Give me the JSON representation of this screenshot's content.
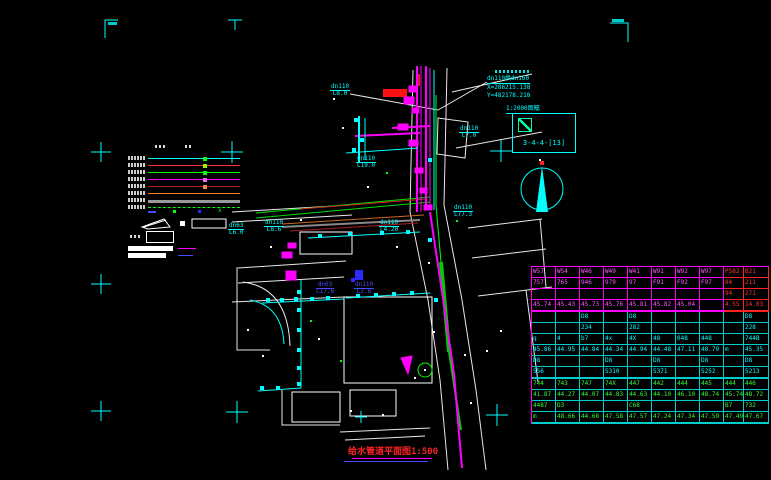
{
  "colors": {
    "background": "#000000",
    "frame": "#00ffff",
    "pipe_new": "#ff00ff",
    "pipe_existing": "#00ffff",
    "road_green": "#00dd00",
    "table_magenta": "#ff00ff",
    "table_red": "#ff3333",
    "table_cyan": "#00ffff",
    "table_green": "#33ff33",
    "title_red": "#ff2222"
  },
  "index_box": {
    "title": "1:2000图幅",
    "code": "3-4-4-[13]",
    "hatch_icon": "hatched-square"
  },
  "node_info": {
    "pipe": "dn110换dn160",
    "x": "X=286215.138",
    "y": "Y=482178.218"
  },
  "north_arrow": "north-arrow",
  "title_block": {
    "text": "给水管道平面图1:500"
  },
  "pipe_labels": [
    {
      "t": "dn110",
      "s": "L8.0",
      "x": 330,
      "y": 84,
      "c": "cyan"
    },
    {
      "t": "dn110",
      "s": "L7.0",
      "x": 459,
      "y": 126,
      "c": "cyan"
    },
    {
      "t": "dn63",
      "s": "L6.0",
      "x": 228,
      "y": 223,
      "c": "cyan"
    },
    {
      "t": "dn110",
      "s": "L8.6",
      "x": 264,
      "y": 220,
      "c": "cyan"
    },
    {
      "t": "dn110",
      "s": "L19.0",
      "x": 356,
      "y": 156,
      "c": "cyan"
    },
    {
      "t": "dn110",
      "s": "L4.20",
      "x": 379,
      "y": 220,
      "c": "cyan"
    },
    {
      "t": "dn110",
      "s": "L77.3",
      "x": 453,
      "y": 205,
      "c": "cyan"
    },
    {
      "t": "dn63",
      "s": "L17.6",
      "x": 316,
      "y": 282,
      "c": "blue"
    },
    {
      "t": "dn110",
      "s": "L2.6",
      "x": 354,
      "y": 282,
      "c": "blue"
    }
  ],
  "legend": {
    "rows": [
      {
        "color": "#00ffff",
        "style": "solid",
        "mark": "#00ff00"
      },
      {
        "color": "#ff2a2a",
        "style": "solid",
        "mark": "#88ff00"
      },
      {
        "color": "#00ff00",
        "style": "solid",
        "mark": "#00ff00"
      },
      {
        "color": "#ff00ff",
        "style": "solid",
        "mark": "#ff66ff"
      },
      {
        "color": "#b22222",
        "style": "solid",
        "mark": "#ff8844"
      },
      {
        "color": "#ff7f27",
        "style": "solid",
        "mark": ""
      },
      {
        "color": "#9a9a9a",
        "style": "thick",
        "mark": ""
      },
      {
        "color": "#00ff00",
        "style": "dashed",
        "mark": ""
      }
    ]
  },
  "table": {
    "col_widths": [
      24,
      24,
      24,
      24,
      24,
      24,
      24,
      24,
      20,
      25
    ],
    "rows": [
      {
        "s": "m",
        "cells": [
          "W57",
          "W54",
          "W46",
          "W49",
          "W41",
          "W91",
          "W92",
          "W97",
          "P582",
          "B21"
        ]
      },
      {
        "s": "m",
        "cells": [
          "757",
          "765",
          "946",
          "979",
          "97",
          "F91",
          "F92",
          "F97",
          "84",
          "211"
        ]
      },
      {
        "s": "m",
        "cells": [
          "",
          "",
          "",
          "",
          "",
          "",
          "",
          "",
          "94",
          "271"
        ]
      },
      {
        "s": "m",
        "end": true,
        "cells": [
          "45.74",
          "45.43",
          "45.73",
          "45.76",
          "45.81",
          "45.82",
          "45.04",
          "",
          "4.55",
          "14.03"
        ]
      },
      {
        "s": "c",
        "cells": [
          "",
          "",
          "D8",
          "",
          "D8",
          "",
          "",
          "",
          "",
          "D8"
        ]
      },
      {
        "s": "c",
        "cells": [
          "",
          "",
          "234",
          "",
          "282",
          "",
          "",
          "",
          "",
          "228"
        ]
      },
      {
        "s": "c",
        "cells": [
          "q",
          "4",
          "b7",
          "4x",
          "4X",
          "48",
          "048",
          "448",
          "",
          "744B"
        ]
      },
      {
        "s": "c",
        "cells": [
          "45.86",
          "44.95",
          "44.84",
          "44.34",
          "44.94",
          "44.48",
          "47.11",
          "48.79",
          "m",
          "45.35"
        ]
      },
      {
        "s": "c",
        "cells": [
          "D8",
          "",
          "",
          "D8",
          "",
          "D8",
          "",
          "D8",
          "",
          "D8"
        ]
      },
      {
        "s": "c",
        "end": true,
        "cells": [
          "556",
          "",
          "",
          "5310",
          "",
          "5371",
          "",
          "5252",
          "",
          "5213"
        ]
      },
      {
        "s": "g",
        "cells": [
          "744",
          "743",
          "747",
          "74X",
          "447",
          "442",
          "444",
          "445",
          "444",
          "446"
        ]
      },
      {
        "s": "g",
        "cells": [
          "41.87",
          "44.27",
          "44.07",
          "44.83",
          "44.63",
          "44.10",
          "46.10",
          "48.74",
          "45.74",
          "48.72"
        ]
      },
      {
        "s": "g",
        "cells": [
          "4487",
          "D3",
          "",
          "",
          "C68",
          "",
          "",
          "",
          "B7",
          "732"
        ]
      },
      {
        "s": "g",
        "end": true,
        "cells": [
          "m",
          "48.66",
          "44.68",
          "47.58",
          "47.57",
          "47.24",
          "47.34",
          "47.59",
          "47.49",
          "47.67"
        ]
      }
    ]
  }
}
